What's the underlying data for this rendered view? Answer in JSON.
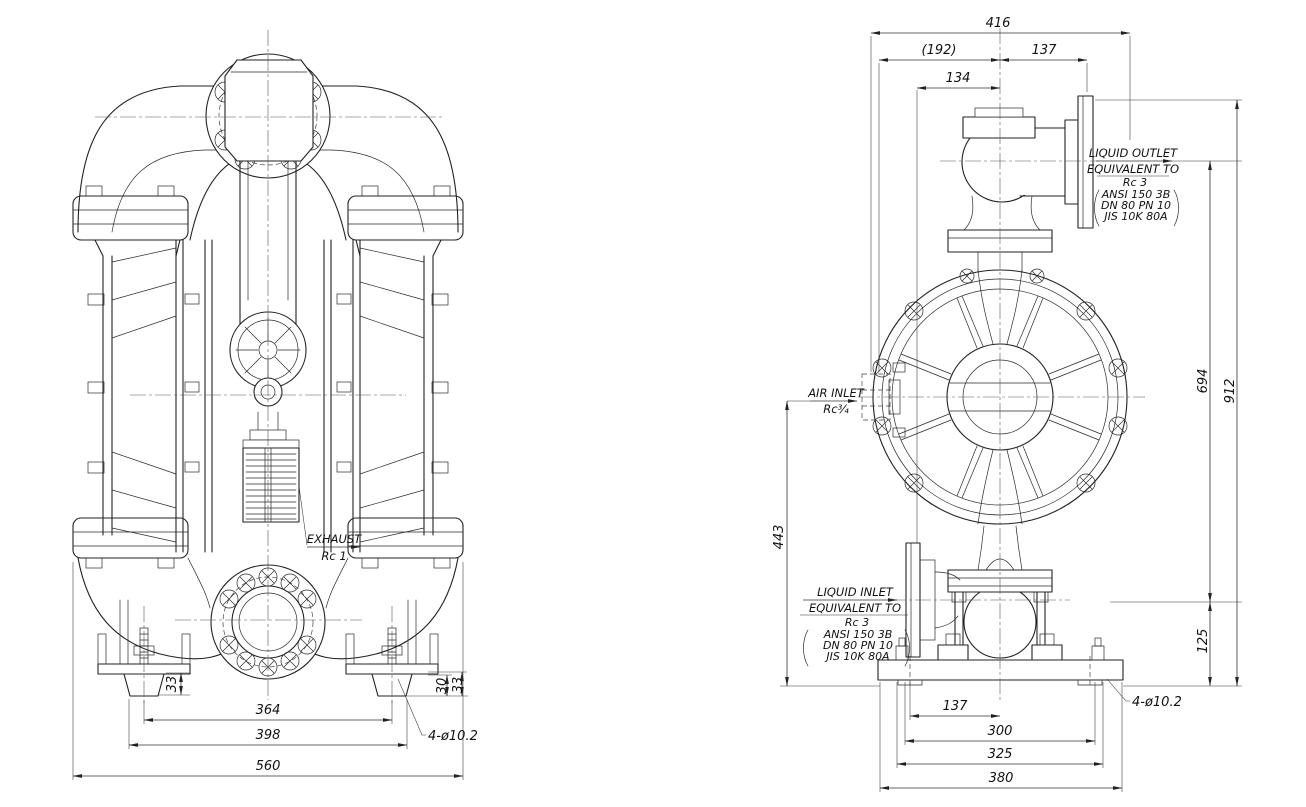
{
  "front_view": {
    "exhaust_label": "EXHAUST",
    "exhaust_size": "Rc 1",
    "holes_label": "4-ø10.2",
    "dim_foot_left": "33",
    "dim_foot_right_inner": "30",
    "dim_foot_right_outer": "33",
    "dim_bolt_span": "364",
    "dim_foot_span": "398",
    "dim_overall_width": "560"
  },
  "side_view": {
    "air_inlet_label": "AIR INLET",
    "air_inlet_size": "Rc¾",
    "holes_label": "4-ø10.2",
    "outlet": {
      "line1": "LIQUID OUTLET",
      "line2": "EQUIVALENT TO",
      "line3": "Rc 3",
      "line4": "ANSI 150  3B",
      "line5": "DN  80  PN  10",
      "line6": "JIS  10K  80A"
    },
    "inlet": {
      "line1": "LIQUID INLET",
      "line2": "EQUIVALENT TO",
      "line3": "Rc 3",
      "line4": "ANSI 150  3B",
      "line5": "DN  80  PN  10",
      "line6": "JIS  10K  80A"
    },
    "dim_overall_depth": "416",
    "dim_ref_depth": "(192)",
    "dim_outlet_offset": "137",
    "dim_muffler_offset": "134",
    "dim_port_distance": "694",
    "dim_overall_height": "912",
    "dim_air_inlet_height": "443",
    "dim_inlet_height": "125",
    "dim_base_hole_offset": "137",
    "dim_base_span_inner": "300",
    "dim_base_span_outer": "325",
    "dim_base_width": "380"
  }
}
